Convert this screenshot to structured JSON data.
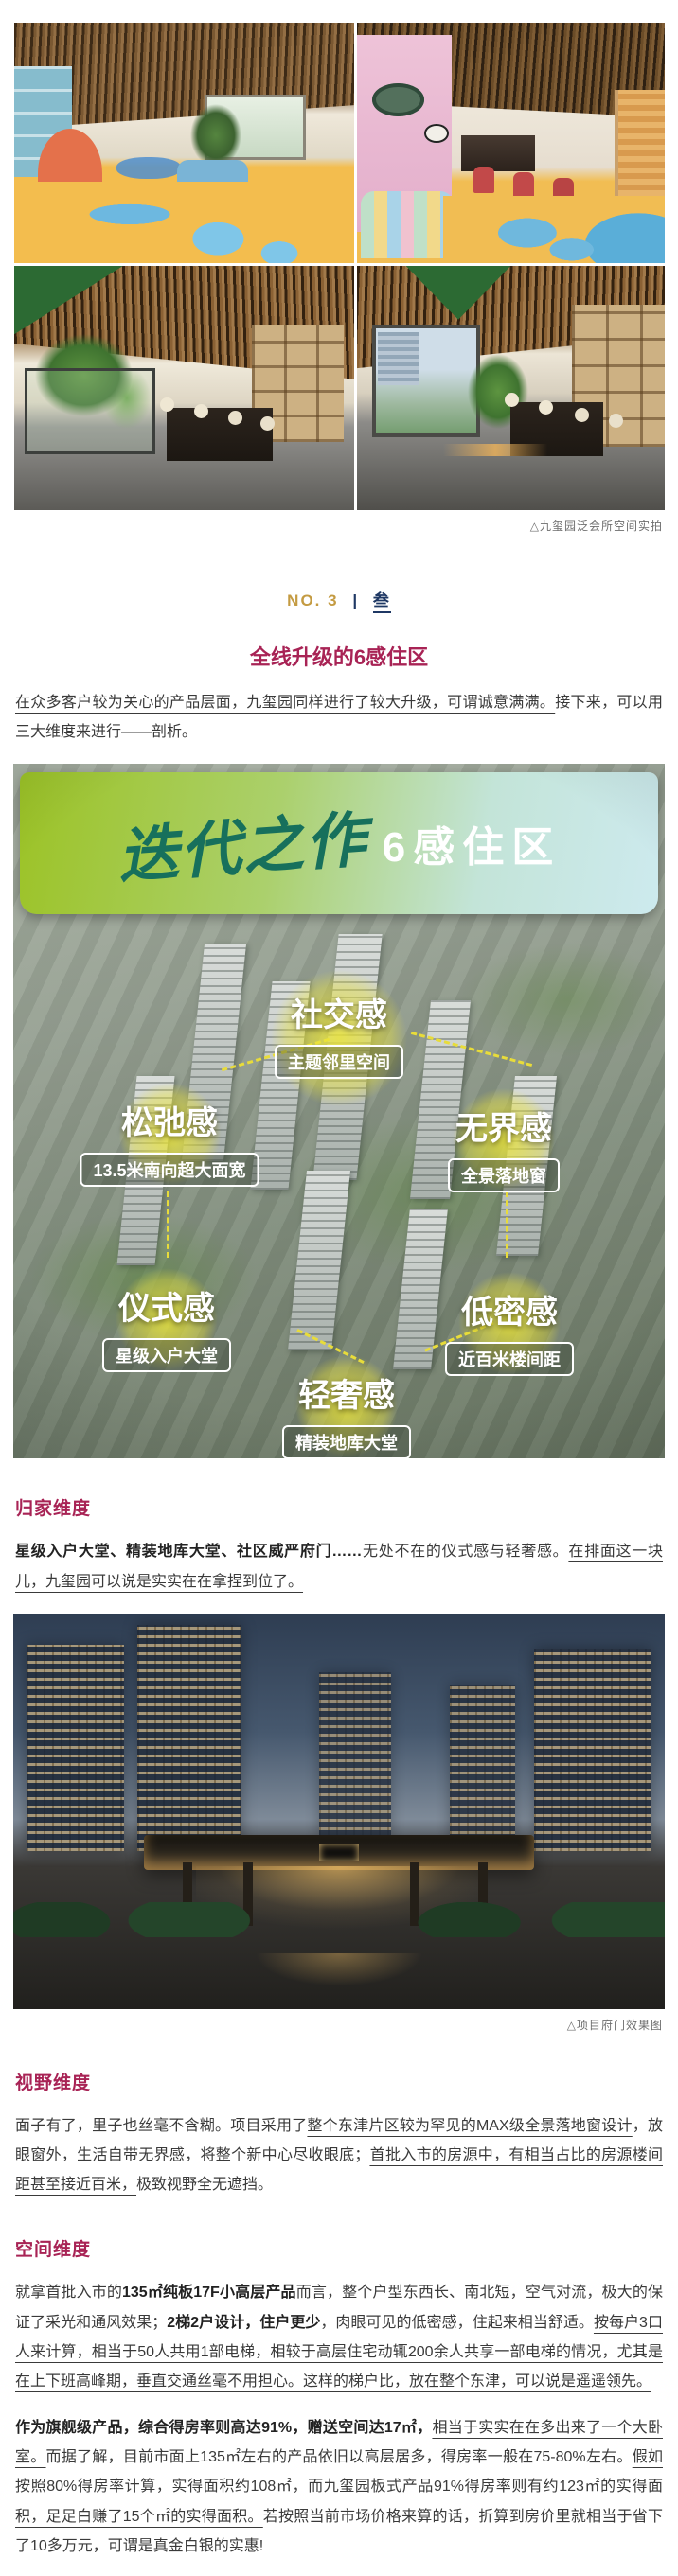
{
  "article": {
    "gallery": {
      "caption": "△九玺园泛会所空间实拍"
    },
    "section_no": {
      "label": "NO. 3",
      "separator": "|",
      "number_cn": "叁"
    },
    "subtitle": "全线升级的6感住区",
    "intro": {
      "runs": [
        {
          "t": "在众多客户较为关心的产品层面，九玺园同样进行了较大升级，可谓诚意满满。",
          "s": "u"
        },
        {
          "t": "接下来，可以用三大维度来进行——剖析。",
          "s": ""
        }
      ]
    },
    "promo": {
      "calligraphy_title": "迭代之作",
      "title_suffix": "6感住区",
      "labels": [
        {
          "title": "社交感",
          "sub": "主题邻里空间"
        },
        {
          "title": "松弛感",
          "sub": "13.5米南向超大面宽"
        },
        {
          "title": "无界感",
          "sub": "全景落地窗"
        },
        {
          "title": "仪式感",
          "sub": "星级入户大堂"
        },
        {
          "title": "低密感",
          "sub": "近百米楼间距"
        },
        {
          "title": "轻奢感",
          "sub": "精装地库大堂"
        }
      ]
    },
    "sections": [
      {
        "heading": "归家维度",
        "paragraphs": [
          [
            {
              "t": "星级入户大堂、精装地库大堂、社区威严府门……",
              "s": "b"
            },
            {
              "t": "无处不在的仪式感与轻奢感。",
              "s": ""
            },
            {
              "t": "在排面这一块儿，九玺园可以说是实实在在拿捏到位了。",
              "s": "u"
            }
          ]
        ]
      },
      {
        "heading": "视野维度",
        "paragraphs": [
          [
            {
              "t": "面子有了，里子也丝毫不含糊。项目采用了",
              "s": ""
            },
            {
              "t": "整个东津片区较为罕见的MAX级全景落地窗设计",
              "s": "u"
            },
            {
              "t": "，放眼窗外，生活自带无界感，将整个新中心尽收眼底；",
              "s": ""
            },
            {
              "t": "首批入市的房源中，有相当占比的房源楼间距甚至接近百米，",
              "s": "u"
            },
            {
              "t": "极致视野全无遮挡。",
              "s": ""
            }
          ]
        ]
      },
      {
        "heading": "空间维度",
        "paragraphs": [
          [
            {
              "t": "就拿首批入市的",
              "s": ""
            },
            {
              "t": "135㎡纯板17F小高层产品",
              "s": "b"
            },
            {
              "t": "而言，",
              "s": ""
            },
            {
              "t": "整个户型东西长、南北短，空气对流，",
              "s": "u"
            },
            {
              "t": "极大的保证了采光和通风效果；",
              "s": ""
            },
            {
              "t": "2梯2户设计，住户更少",
              "s": "b"
            },
            {
              "t": "，肉眼可见的低密感，住起来相当舒适。",
              "s": ""
            },
            {
              "t": "按每户3口人来计算，相当于50人共用1部电梯，相较于高层住宅动辄200余人共享一部电梯的情况，尤其是在上下班高峰期，垂直交通丝毫不用担心。这样的梯户比，放在整个东津，可以说是遥遥领先。",
              "s": "u"
            }
          ],
          [
            {
              "t": "作为旗舰级产品，综合得房率则高达91%，赠送空间达17㎡，",
              "s": "b"
            },
            {
              "t": "相当于实实在在多出来了一个大卧室。",
              "s": "u"
            },
            {
              "t": "而据了解，目前市面上135㎡左右的产品依旧以高层居多，得房率一般在75-80%左右。",
              "s": ""
            },
            {
              "t": "假如按照80%得房率计算，实得面积约108㎡，而九玺园板式产品91%得房率则有约123㎡的实得面积，足足白赚了15个㎡的实得面积。",
              "s": "u"
            },
            {
              "t": "若按照当前市场价格来算的话，折算到房价里就相当于省下了10多万元，可谓是真金白银的实惠!",
              "s": ""
            }
          ]
        ]
      }
    ],
    "project_caption": "△项目府门效果图",
    "colors": {
      "accent_magenta": "#A82355",
      "gold": "#C49B42",
      "navy": "#1F3864",
      "banner_green": "#9CC326",
      "banner_cyan": "#CDEAEE",
      "calligraphy_teal": "#17705C",
      "glow_yellow": "#E8DC3A"
    }
  }
}
